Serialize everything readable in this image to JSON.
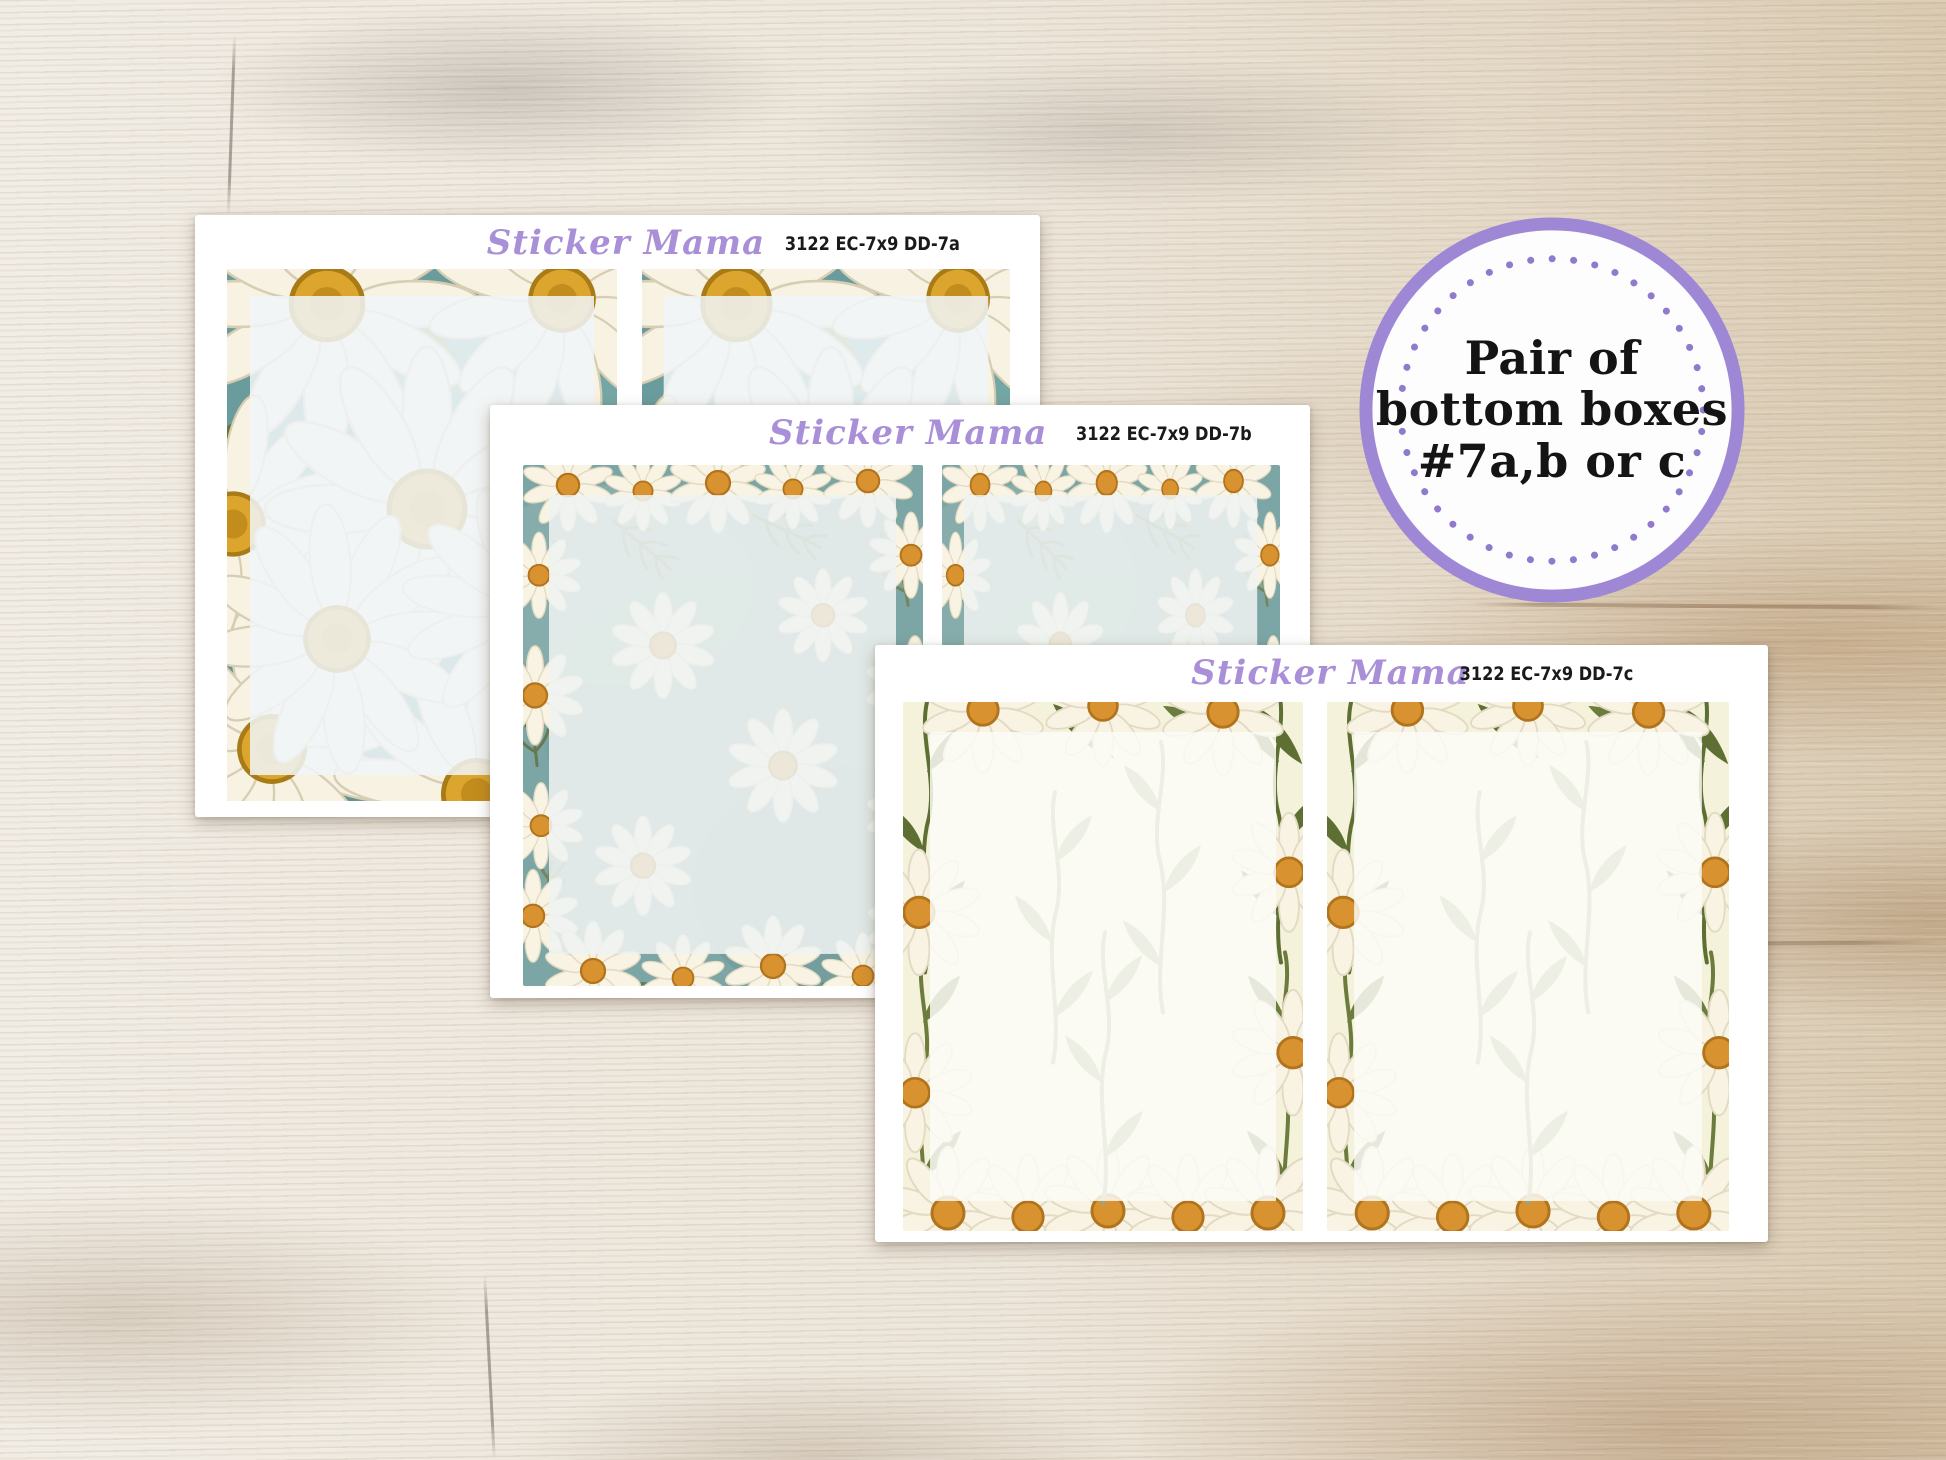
{
  "badge": {
    "line1": "Pair of",
    "line2": "bottom boxes",
    "line3": "#7a,b or c"
  },
  "sheets": [
    {
      "brand": "Sticker Mama",
      "code": "3122 EC-7x9 DD-7a",
      "pattern": "large-white-daisies-on-teal"
    },
    {
      "brand": "Sticker Mama",
      "code": "3122 EC-7x9 DD-7b",
      "pattern": "wild-chamomile-daisies-on-teal"
    },
    {
      "brand": "Sticker Mama",
      "code": "3122 EC-7x9 DD-7c",
      "pattern": "daisy-stems-on-cream"
    }
  ],
  "colors": {
    "brand_purple": "#a98fd8",
    "badge_purple": "#9e88d5",
    "code_text": "#1a1a1a",
    "teal_sheet_a": "#6a9c9d",
    "teal_sheet_b": "#7ca5a5",
    "cream_sheet_c": "#f5f2db",
    "daisy_center_gold": "#dca62e"
  }
}
